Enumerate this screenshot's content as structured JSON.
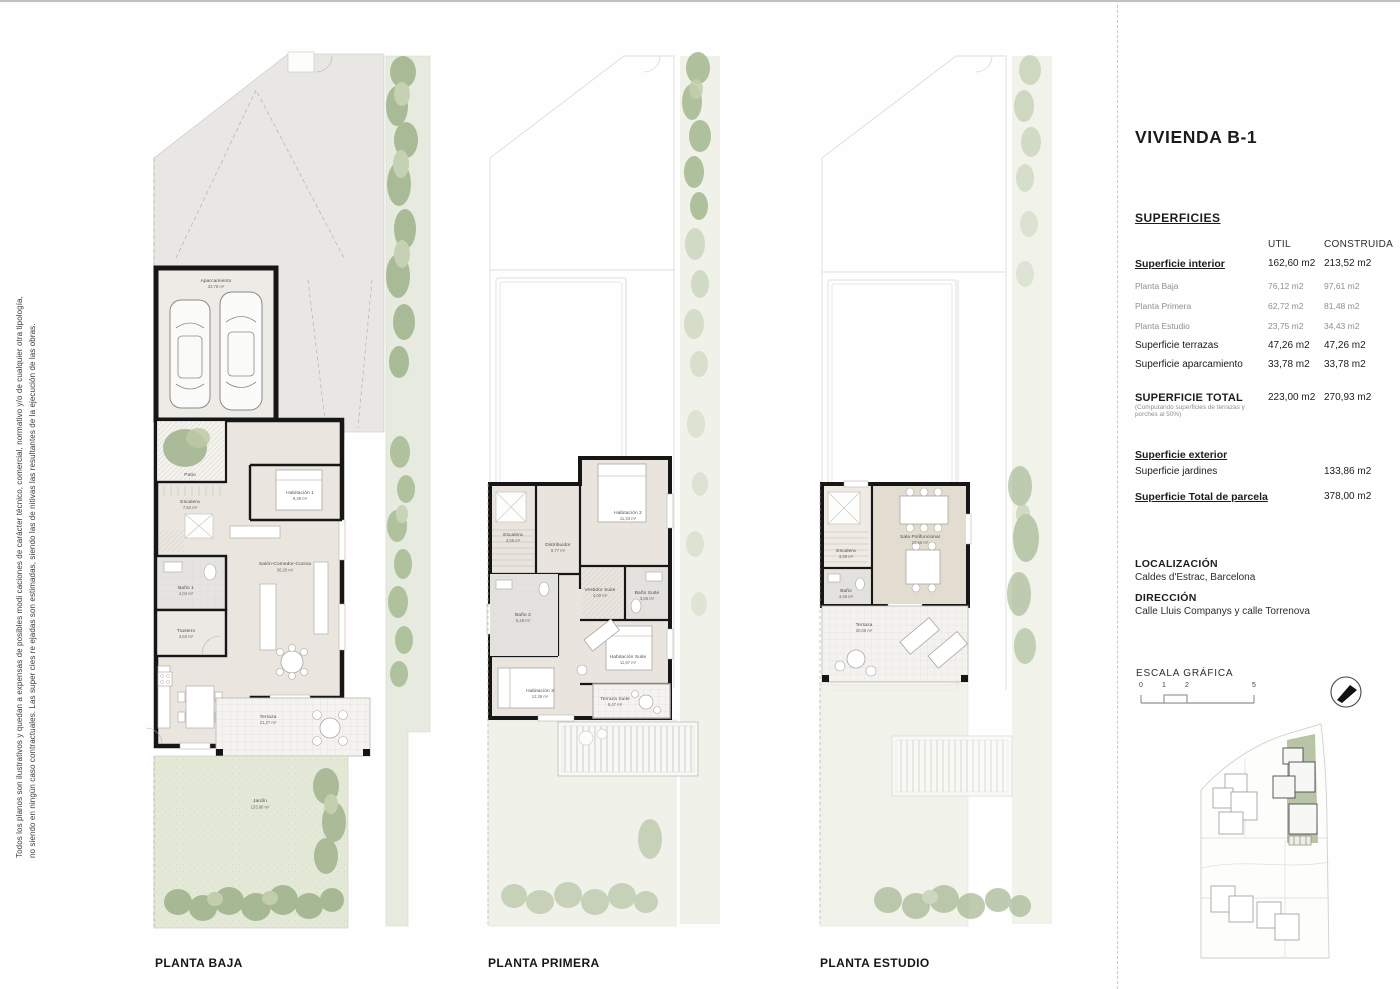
{
  "title": "VIVIENDA B-1",
  "disclaimer": {
    "line1": "Todos los planos son ilustrativos y quedan a expensas de posibles modi caciones de carácter técnico, comercial, normativo y/o de cualquier otra tipología,",
    "line2": "no siendo en ningún caso contractuales. Las super cies re ejadas son estimadas, siendo las de nitivas las resultantes de la ejecución de las obras."
  },
  "plans": {
    "baja": {
      "label": "PLANTA BAJA",
      "rooms": {
        "aparcamiento": {
          "name": "Aparcamiento",
          "area": "33,78 m²"
        },
        "acceso": {
          "name": "Acceso"
        },
        "patio": {
          "name": "Patio"
        },
        "escalera": {
          "name": "Escalera",
          "area": "7,52 m²"
        },
        "habitacion1": {
          "name": "Habitación 1",
          "area": "9,39 m²"
        },
        "salon": {
          "name": "Salón-Comedor-Cocina",
          "area": "36,26 m²"
        },
        "bano1": {
          "name": "Baño 1",
          "area": "4,04 m²"
        },
        "trastero": {
          "name": "Trastero",
          "area": "3,63 m²"
        },
        "terraza": {
          "name": "Terraza",
          "area": "21,27 m²"
        },
        "jardin": {
          "name": "Jardín",
          "area": "133,86 m²"
        }
      }
    },
    "primera": {
      "label": "PLANTA PRIMERA",
      "rooms": {
        "escalera": {
          "name": "Escalera",
          "area": "3,55 m²"
        },
        "distribuidor": {
          "name": "Distribuidor",
          "area": "6,77 m²"
        },
        "habitacion2": {
          "name": "Habitación 2",
          "area": "11,33 m²"
        },
        "vestidor": {
          "name": "Vestidor Suite",
          "area": "4,00 m²"
        },
        "banosuite": {
          "name": "Baño Suite",
          "area": "3,86 m²"
        },
        "bano2": {
          "name": "Baño 2",
          "area": "5,49 m²"
        },
        "habitacionsuite": {
          "name": "Habitación Suite",
          "area": "11,87 m²"
        },
        "habitacion3": {
          "name": "Habitación 3",
          "area": "12,39 m²"
        },
        "terrazasuite": {
          "name": "Terraza Suite",
          "area": "5,47 m²"
        }
      }
    },
    "estudio": {
      "label": "PLANTA ESTUDIO",
      "rooms": {
        "escalera": {
          "name": "Escalera",
          "area": "3,59 m²"
        },
        "bano": {
          "name": "Baño",
          "area": "3,46 m²"
        },
        "sala": {
          "name": "Sala Polifuncional",
          "area": "19,56 m²"
        },
        "terraza": {
          "name": "Terraza",
          "area": "20,06 m²"
        }
      }
    }
  },
  "panel": {
    "superficies_heading": "SUPERFICIES",
    "columns": {
      "util": "UTIL",
      "construida": "CONSTRUIDA"
    },
    "rows": {
      "interior": {
        "label": "Superficie interior",
        "util": "162,60 m2",
        "construida": "213,52 m2"
      },
      "planta_baja": {
        "label": "Planta Baja",
        "util": "76,12 m2",
        "construida": "97,61 m2"
      },
      "planta_primera": {
        "label": "Planta Primera",
        "util": "62,72 m2",
        "construida": "81,48 m2"
      },
      "planta_estudio": {
        "label": "Planta Estudio",
        "util": "23,75 m2",
        "construida": "34,43 m2"
      },
      "terrazas": {
        "label": "Superficie terrazas",
        "util": "47,26 m2",
        "construida": "47,26 m2"
      },
      "aparcamiento": {
        "label": "Superficie aparcamiento",
        "util": "33,78 m2",
        "construida": "33,78 m2"
      },
      "total": {
        "label": "SUPERFICIE TOTAL",
        "note": "(Computando superficies de terrazas y porches al 50%)",
        "util": "223,00 m2",
        "construida": "270,93 m2"
      }
    },
    "exterior": {
      "heading": "Superficie exterior",
      "jardines_label": "Superficie jardines",
      "jardines_value": "133,86 m2",
      "parcela_label": "Superficie Total de parcela",
      "parcela_value": "378,00 m2"
    },
    "localizacion": {
      "heading": "LOCALIZACIÓN",
      "value": "Caldes d'Estrac, Barcelona"
    },
    "direccion": {
      "heading": "DIRECCIÓN",
      "value": "Calle Lluis Companys y calle Torrenova"
    },
    "escala": {
      "heading": "ESCALA GRÁFICA",
      "ticks": {
        "t0": "0",
        "t1": "1",
        "t2": "2",
        "t5": "5"
      }
    }
  },
  "colors": {
    "wall": "#161616",
    "house_fill": "#eae6df",
    "driveway": "#e9e7e3",
    "terrace": "#f4f3ef",
    "garden": "#e4e8d6",
    "shrub": "#a3b78f",
    "site_highlight": "#b9c3a5"
  }
}
